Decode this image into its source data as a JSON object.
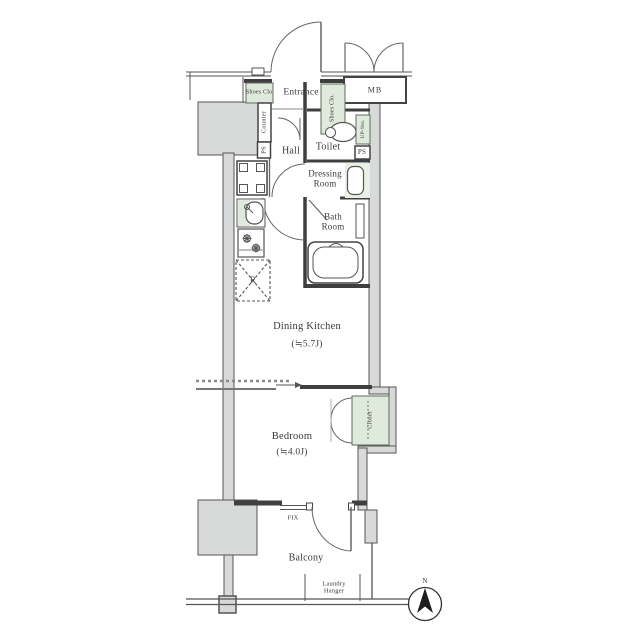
{
  "floorplan": {
    "labels": {
      "shoes_clo_top": "Shoes Clo.",
      "entrance": "Entrance",
      "shoes_clo_side": "Shoes Clo.",
      "mb": "MB",
      "counter": "Counter",
      "ps_left": "PS",
      "hall": "Hall",
      "toilet": "Toilet",
      "up_sto": "UP-Sto.",
      "ps_right": "PS",
      "dressing_room": "Dressing Room",
      "bath_room": "Bath Room",
      "refrigerator": "R",
      "dining_kitchen": "Dining Kitchen",
      "dining_kitchen_size": "(≒5.7J)",
      "bedroom": "Bedroom",
      "bedroom_size": "(≒4.0J)",
      "closet": "Closet",
      "fix": "FIX",
      "balcony": "Balcony",
      "laundry_hanger": "Laundry Hanger",
      "north": "N"
    },
    "colors": {
      "wall_dark": "#3f3f3f",
      "wall_line": "#555555",
      "pillar_gray": "#d7dad9",
      "fixture_green": "#dfe9dc",
      "dressing_green": "#e9f1e7",
      "text": "#3b3b3b"
    }
  }
}
